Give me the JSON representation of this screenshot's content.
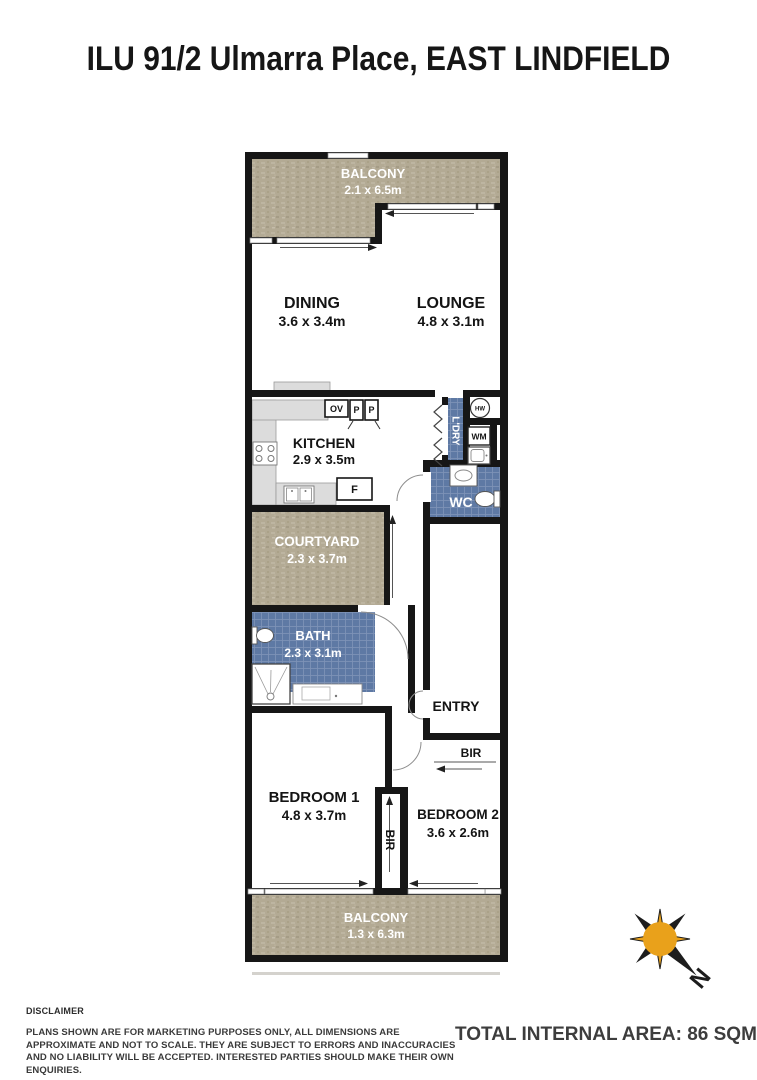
{
  "page": {
    "title": "ILU 91/2 Ulmarra Place, EAST LINDFIELD"
  },
  "floorplan": {
    "balcony_top": {
      "name": "BALCONY",
      "dims": "2.1 x 6.5m"
    },
    "dining": {
      "name": "DINING",
      "dims": "3.6 x 3.4m"
    },
    "lounge": {
      "name": "LOUNGE",
      "dims": "4.8 x 3.1m"
    },
    "kitchen": {
      "name": "KITCHEN",
      "dims": "2.9 x 3.5m"
    },
    "laundry": {
      "name": "L'DRY"
    },
    "hot_water": {
      "name": "HW"
    },
    "washing_machine": {
      "name": "WM"
    },
    "wc": {
      "name": "WC"
    },
    "courtyard": {
      "name": "COURTYARD",
      "dims": "2.3 x 3.7m"
    },
    "bath": {
      "name": "BATH",
      "dims": "2.3 x 3.1m"
    },
    "entry": {
      "name": "ENTRY"
    },
    "bir_bedroom2": {
      "name": "BIR"
    },
    "bir_middle": {
      "name": "BIR"
    },
    "bedroom1": {
      "name": "BEDROOM 1",
      "dims": "4.8 x 3.7m"
    },
    "bedroom2": {
      "name": "BEDROOM 2",
      "dims": "3.6 x 2.6m"
    },
    "balcony_bottom": {
      "name": "BALCONY",
      "dims": "1.3 x 6.3m"
    },
    "appliances": {
      "oven": "OV",
      "pantry1": "P",
      "pantry2": "P",
      "fridge": "F"
    }
  },
  "compass": {
    "north": "N"
  },
  "footer": {
    "disclaimer_title": "DISCLAIMER",
    "disclaimer_body": "PLANS SHOWN ARE FOR MARKETING PURPOSES ONLY, ALL DIMENSIONS ARE APPROXIMATE AND NOT TO SCALE. THEY ARE SUBJECT TO ERRORS AND INACCURACIES AND NO LIABILITY WILL BE ACCEPTED. INTERESTED PARTIES SHOULD MAKE THEIR OWN ENQUIRIES.",
    "total_area": "TOTAL INTERNAL AREA: 86 SQM"
  },
  "colors": {
    "render_beige": "#b1a892",
    "tile_blue": "#5e79a4",
    "wall": "#161616",
    "compass_gold": "#e9a11b"
  }
}
